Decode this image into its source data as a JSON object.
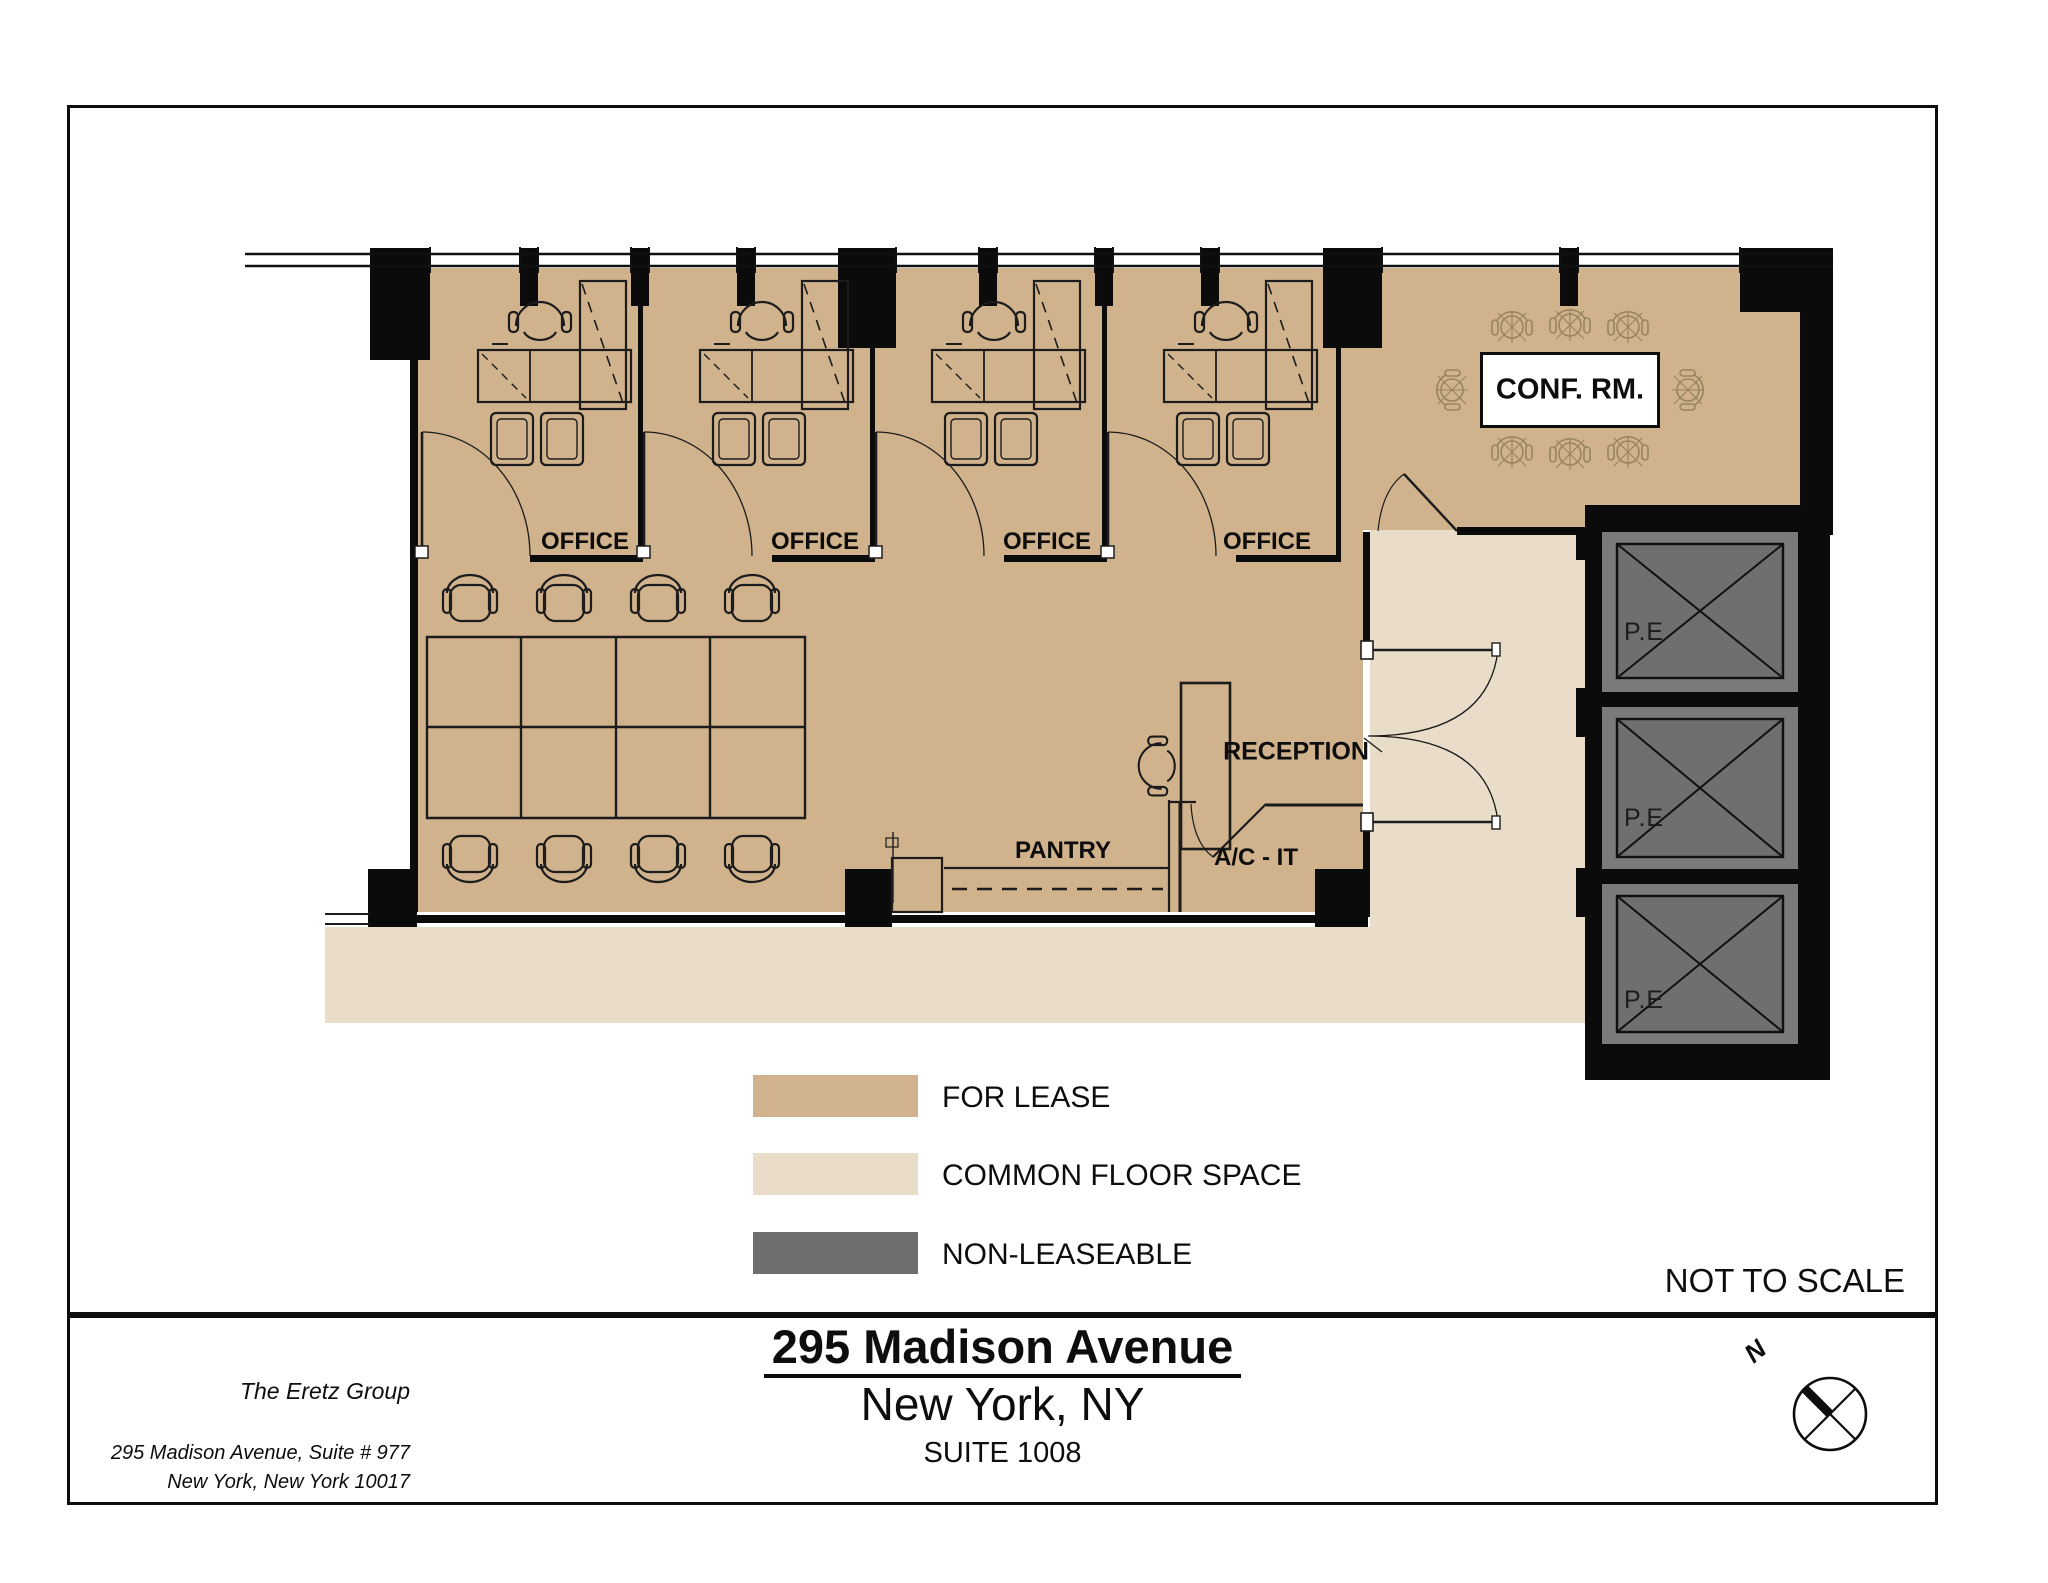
{
  "page": {
    "scale_note": "NOT TO SCALE"
  },
  "plan": {
    "offices": [
      {
        "label": "OFFICE"
      },
      {
        "label": "OFFICE"
      },
      {
        "label": "OFFICE"
      },
      {
        "label": "OFFICE"
      }
    ],
    "conference_room": {
      "label": "CONF. RM."
    },
    "reception": {
      "label": "RECEPTION"
    },
    "pantry": {
      "label": "PANTRY"
    },
    "ac_it_room": {
      "label": "A/C - IT"
    },
    "elevators": [
      {
        "label": "P.E"
      },
      {
        "label": "P.E"
      },
      {
        "label": "P.E"
      }
    ],
    "compass": {
      "label": "N"
    }
  },
  "legend": {
    "items": [
      {
        "label": "FOR LEASE",
        "color": "#d0b28c"
      },
      {
        "label": "COMMON FLOOR SPACE",
        "color": "#e9dcc8"
      },
      {
        "label": "NON-LEASEABLE",
        "color": "#6e6e6e"
      }
    ]
  },
  "title_block": {
    "building": "295 Madison Avenue",
    "city": "New York, NY",
    "suite": "SUITE 1008"
  },
  "broker": {
    "name": "The Eretz Group",
    "address_line1": "295 Madison Avenue, Suite # 977",
    "address_line2": "New York, New York 10017"
  },
  "colors": {
    "for_lease": "#d0b28c",
    "common_floor_space": "#e9dcc8",
    "non_leaseable": "#6e6e6e",
    "wall": "#0b0b0b"
  }
}
